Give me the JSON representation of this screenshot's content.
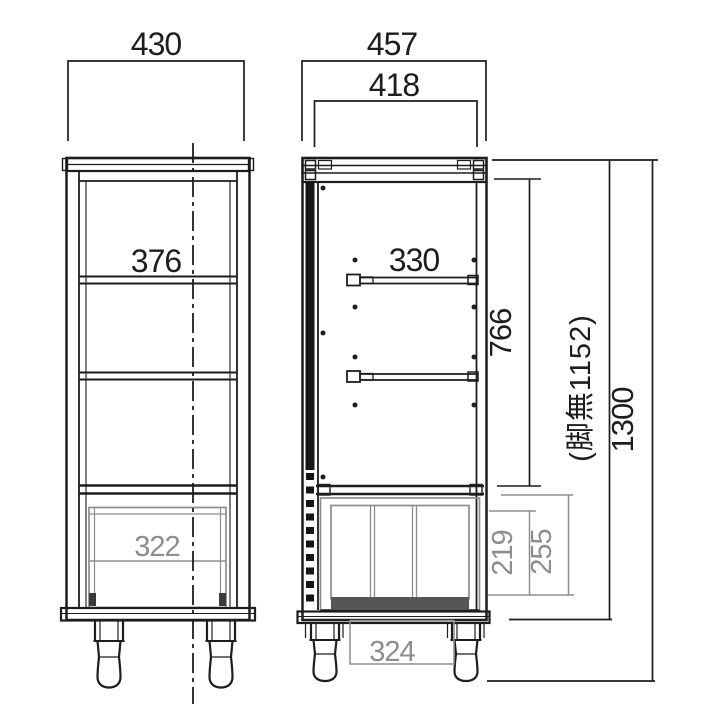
{
  "drawing": {
    "kind": "furniture-dimension-diagram",
    "units": "mm",
    "views": {
      "front": {
        "overall_width": "430",
        "inner_shelf_width": "376",
        "drawer_width": "322"
      },
      "side": {
        "overall_depth": "457",
        "inner_depth": "418",
        "shelf_depth": "330",
        "upper_compartment_height": "766",
        "lower_inner_height": "219",
        "lower_section_height": "255",
        "leg_span": "324",
        "height_without_legs": "(脚無1152)",
        "overall_height": "1300"
      }
    },
    "colors": {
      "line": "#1d1d1d",
      "secondary": "#8d8d8d",
      "dark_fill": "#555555",
      "background": "#ffffff"
    }
  }
}
